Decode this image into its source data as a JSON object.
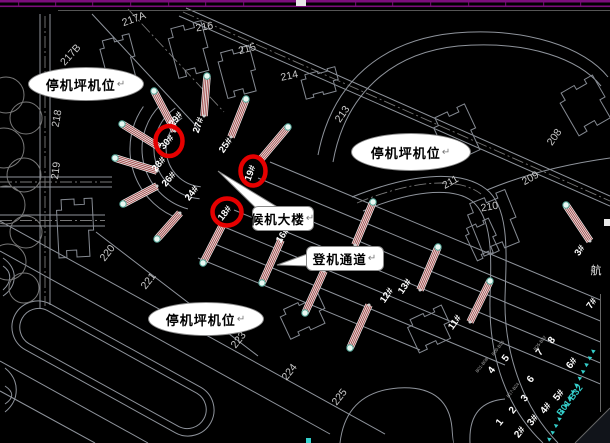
{
  "colors": {
    "background": "#000000",
    "cad_line": "#8f949c",
    "purple_band": "#7c0d7c",
    "red_circle": "#e60000",
    "bridge_red": "#9a4040",
    "cyan": "#35d0cc",
    "plot_label": "#c8c8c8",
    "gate_label": "#ffffff"
  },
  "callouts": {
    "apron1": {
      "label": "停机坪机位",
      "mark": "↵"
    },
    "apron2": {
      "label": "停机坪机位",
      "mark": "↵"
    },
    "apron3": {
      "label": "停机坪机位",
      "mark": "↵"
    },
    "terminal": {
      "label": "候机大楼",
      "mark": "↵"
    },
    "corridor": {
      "label": "登机通道",
      "mark": "↵"
    }
  },
  "plot_labels": [
    {
      "text": "217A",
      "x": 135,
      "y": 22,
      "rot": -20
    },
    {
      "text": "216",
      "x": 205,
      "y": 30,
      "rot": -10
    },
    {
      "text": "215",
      "x": 248,
      "y": 52,
      "rot": -15
    },
    {
      "text": "214",
      "x": 290,
      "y": 79,
      "rot": -12
    },
    {
      "text": "213",
      "x": 345,
      "y": 116,
      "rot": -55
    },
    {
      "text": "208",
      "x": 557,
      "y": 139,
      "rot": -55
    },
    {
      "text": "209",
      "x": 532,
      "y": 181,
      "rot": -30
    },
    {
      "text": "210",
      "x": 490,
      "y": 210,
      "rot": -10
    },
    {
      "text": "211",
      "x": 452,
      "y": 185,
      "rot": -30
    },
    {
      "text": "217B",
      "x": 73,
      "y": 57,
      "rot": -48
    },
    {
      "text": "218",
      "x": 60,
      "y": 119,
      "rot": -80
    },
    {
      "text": "219",
      "x": 59,
      "y": 171,
      "rot": -83
    },
    {
      "text": "220",
      "x": 110,
      "y": 255,
      "rot": -52
    },
    {
      "text": "221",
      "x": 151,
      "y": 283,
      "rot": -52
    },
    {
      "text": "223",
      "x": 241,
      "y": 342,
      "rot": -52
    },
    {
      "text": "224",
      "x": 292,
      "y": 374,
      "rot": -52
    },
    {
      "text": "225",
      "x": 342,
      "y": 399,
      "rot": -52
    }
  ],
  "gate_labels": [
    {
      "text": "29#",
      "x": 178,
      "y": 121,
      "rot": -52
    },
    {
      "text": "27#",
      "x": 201,
      "y": 126,
      "rot": -72
    },
    {
      "text": "25#",
      "x": 228,
      "y": 147,
      "rot": -55
    },
    {
      "text": "28#",
      "x": 161,
      "y": 166,
      "rot": -50
    },
    {
      "text": "26#",
      "x": 171,
      "y": 181,
      "rot": -50
    },
    {
      "text": "24#",
      "x": 194,
      "y": 195,
      "rot": -52
    },
    {
      "text": "16#",
      "x": 285,
      "y": 237,
      "rot": -55
    },
    {
      "text": "12#",
      "x": 389,
      "y": 297,
      "rot": -55
    },
    {
      "text": "13#",
      "x": 407,
      "y": 288,
      "rot": -55
    },
    {
      "text": "11#",
      "x": 457,
      "y": 324,
      "rot": -55
    },
    {
      "text": "3#",
      "x": 582,
      "y": 252,
      "rot": -55
    },
    {
      "text": "7#",
      "x": 594,
      "y": 305,
      "rot": -55
    }
  ],
  "circled_gates": [
    {
      "text": "30#",
      "cx": 169,
      "cy": 141,
      "rx": 13.5,
      "ry": 15,
      "rot": -48
    },
    {
      "text": "19#",
      "cx": 253,
      "cy": 171,
      "rx": 12.5,
      "ry": 14.5,
      "rot": -70
    },
    {
      "text": "18#",
      "cx": 227,
      "cy": 212,
      "rx": 14.5,
      "ry": 13.5,
      "rot": -52
    }
  ],
  "stand_grid": {
    "numbers": [
      {
        "text": "1",
        "x": 502,
        "y": 424
      },
      {
        "text": "2",
        "x": 515,
        "y": 412
      },
      {
        "text": "3",
        "x": 527,
        "y": 400
      },
      {
        "text": "4",
        "x": 494,
        "y": 372
      },
      {
        "text": "5",
        "x": 508,
        "y": 360
      },
      {
        "text": "6",
        "x": 533,
        "y": 381
      },
      {
        "text": "7",
        "x": 542,
        "y": 354
      },
      {
        "text": "8",
        "x": 554,
        "y": 342
      }
    ],
    "gates": [
      {
        "text": "2#",
        "x": 522,
        "y": 434
      },
      {
        "text": "3#",
        "x": 535,
        "y": 422
      },
      {
        "text": "4#",
        "x": 548,
        "y": 410
      },
      {
        "text": "5#",
        "x": 561,
        "y": 397
      },
      {
        "text": "6#",
        "x": 574,
        "y": 365
      }
    ],
    "codes": [
      {
        "text": "B01-B08",
        "x": 483,
        "y": 366
      },
      {
        "text": "B09-B16",
        "x": 499,
        "y": 349
      },
      {
        "text": "B17-B24",
        "x": 514,
        "y": 391
      },
      {
        "text": "B25-B32",
        "x": 541,
        "y": 344
      }
    ],
    "rot": -52
  },
  "cyan_band": {
    "label": "B01-B32",
    "x": 572,
    "y": 402,
    "rot": -52,
    "triangles": {
      "x1": 549,
      "y1": 439,
      "x2": 593,
      "y2": 351,
      "count": 14
    }
  },
  "right_edge": {
    "terminal_text": "航",
    "x": 596,
    "y": 274
  },
  "bridges": [
    {
      "x1": 115,
      "y1": 158,
      "x2": 157,
      "y2": 171
    },
    {
      "x1": 122,
      "y1": 124,
      "x2": 159,
      "y2": 147
    },
    {
      "x1": 154,
      "y1": 91,
      "x2": 175,
      "y2": 131
    },
    {
      "x1": 207,
      "y1": 76,
      "x2": 204,
      "y2": 116
    },
    {
      "x1": 246,
      "y1": 99,
      "x2": 231,
      "y2": 137
    },
    {
      "x1": 288,
      "y1": 127,
      "x2": 261,
      "y2": 159
    },
    {
      "x1": 123,
      "y1": 204,
      "x2": 157,
      "y2": 186
    },
    {
      "x1": 157,
      "y1": 239,
      "x2": 180,
      "y2": 213
    },
    {
      "x1": 203,
      "y1": 263,
      "x2": 222,
      "y2": 226
    },
    {
      "x1": 262,
      "y1": 283,
      "x2": 281,
      "y2": 240
    },
    {
      "x1": 305,
      "y1": 313,
      "x2": 324,
      "y2": 271
    },
    {
      "x1": 350,
      "y1": 348,
      "x2": 369,
      "y2": 305
    },
    {
      "x1": 373,
      "y1": 202,
      "x2": 355,
      "y2": 245
    },
    {
      "x1": 438,
      "y1": 247,
      "x2": 420,
      "y2": 290
    },
    {
      "x1": 490,
      "y1": 281,
      "x2": 470,
      "y2": 322
    },
    {
      "x1": 566,
      "y1": 205,
      "x2": 590,
      "y2": 241
    }
  ]
}
